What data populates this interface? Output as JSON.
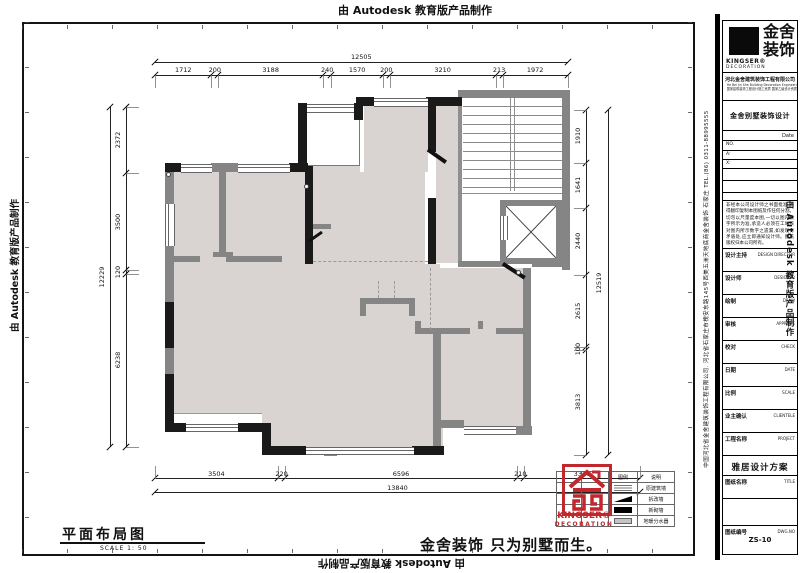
{
  "watermark": "由 Autodesk 教育版产品制作",
  "plan": {
    "figure_title": "平面布局图",
    "figure_scale": "SCALE 1: 50",
    "dims": {
      "top": {
        "overall": "12505",
        "segments": [
          "1712",
          "200",
          "3188",
          "240",
          "1570",
          "200",
          "3210",
          "213",
          "1972"
        ]
      },
      "bottom": {
        "overall": "13840",
        "segments": [
          "3504",
          "220",
          "6596",
          "210",
          "3310"
        ]
      },
      "left": {
        "overall": "12229",
        "segments": [
          "2372",
          "3500",
          "120",
          "6238"
        ]
      },
      "right": {
        "overall": "12519",
        "segments": [
          "1910",
          "1641",
          "2440",
          "2615",
          "100",
          "3813"
        ]
      }
    }
  },
  "legend": {
    "headers": [
      "图例",
      "说明"
    ],
    "rows": [
      {
        "symbol": "hatch",
        "desc": "原建筑墙"
      },
      {
        "symbol": "wedge",
        "desc": "拆改墙"
      },
      {
        "symbol": "solid",
        "desc": "新砌墙"
      },
      {
        "symbol": "manifold",
        "desc": "地暖分水器"
      }
    ]
  },
  "stamp": {
    "brand": "KINGSER®",
    "sub": "DECORATION"
  },
  "slogan": "金舍装饰 只为别墅而生。",
  "titleblock": {
    "logo_zh_1": "金舍",
    "logo_zh_2": "装饰",
    "brand": "KINGSER®",
    "brand_sub": "DECORATION",
    "company": "河北金舍建筑装饰工程有限公司",
    "company_en": "He Bei Jin She Building Decoration Engineering Co., Ltd",
    "company_sub": "国家建筑装饰工程设计施工资质 国家乙级设计资质",
    "project": "金舍别墅装饰设计",
    "date_label": "Date",
    "no_label": "NO.",
    "field_a": "A:",
    "field_b": "X:",
    "notice": "非经本公司设计师之书面批准,不得翻印复制本图纸及作任何分割。切勿以尺量度本图,一切以图内数字所示为准,承造人必须在工地核对图内所示数字之遗漏,如发现有矛盾处,应立即通知设计师。图纸版权归本公司所有。",
    "rows": [
      {
        "zh": "设计主持",
        "en": "DESIGN DIRECTOR"
      },
      {
        "zh": "设计师",
        "en": "DESIGNER"
      },
      {
        "zh": "绘制",
        "en": "DRAW"
      },
      {
        "zh": "审核",
        "en": "APPROVE"
      },
      {
        "zh": "校对",
        "en": "CHECK"
      },
      {
        "zh": "日期",
        "en": "DATE"
      },
      {
        "zh": "比例",
        "en": "SCALE"
      },
      {
        "zh": "业主确认",
        "en": "CLIENTELE"
      },
      {
        "zh": "工程名称",
        "en": "PROJECT"
      }
    ],
    "project_name": "雅居设计方案",
    "sheet": {
      "zh": "图纸名称",
      "en": "TITLE"
    },
    "dwg": {
      "zh": "图纸编号",
      "en": "DWG.NO",
      "value": "ZS-10"
    },
    "side_company": "中国河北省金舍建筑装饰工程有限公司. 河北省石家庄市槐安东路145号西美五洲天地底商金舍装饰 石家庄 TEL.(86) 0311-88995555"
  }
}
